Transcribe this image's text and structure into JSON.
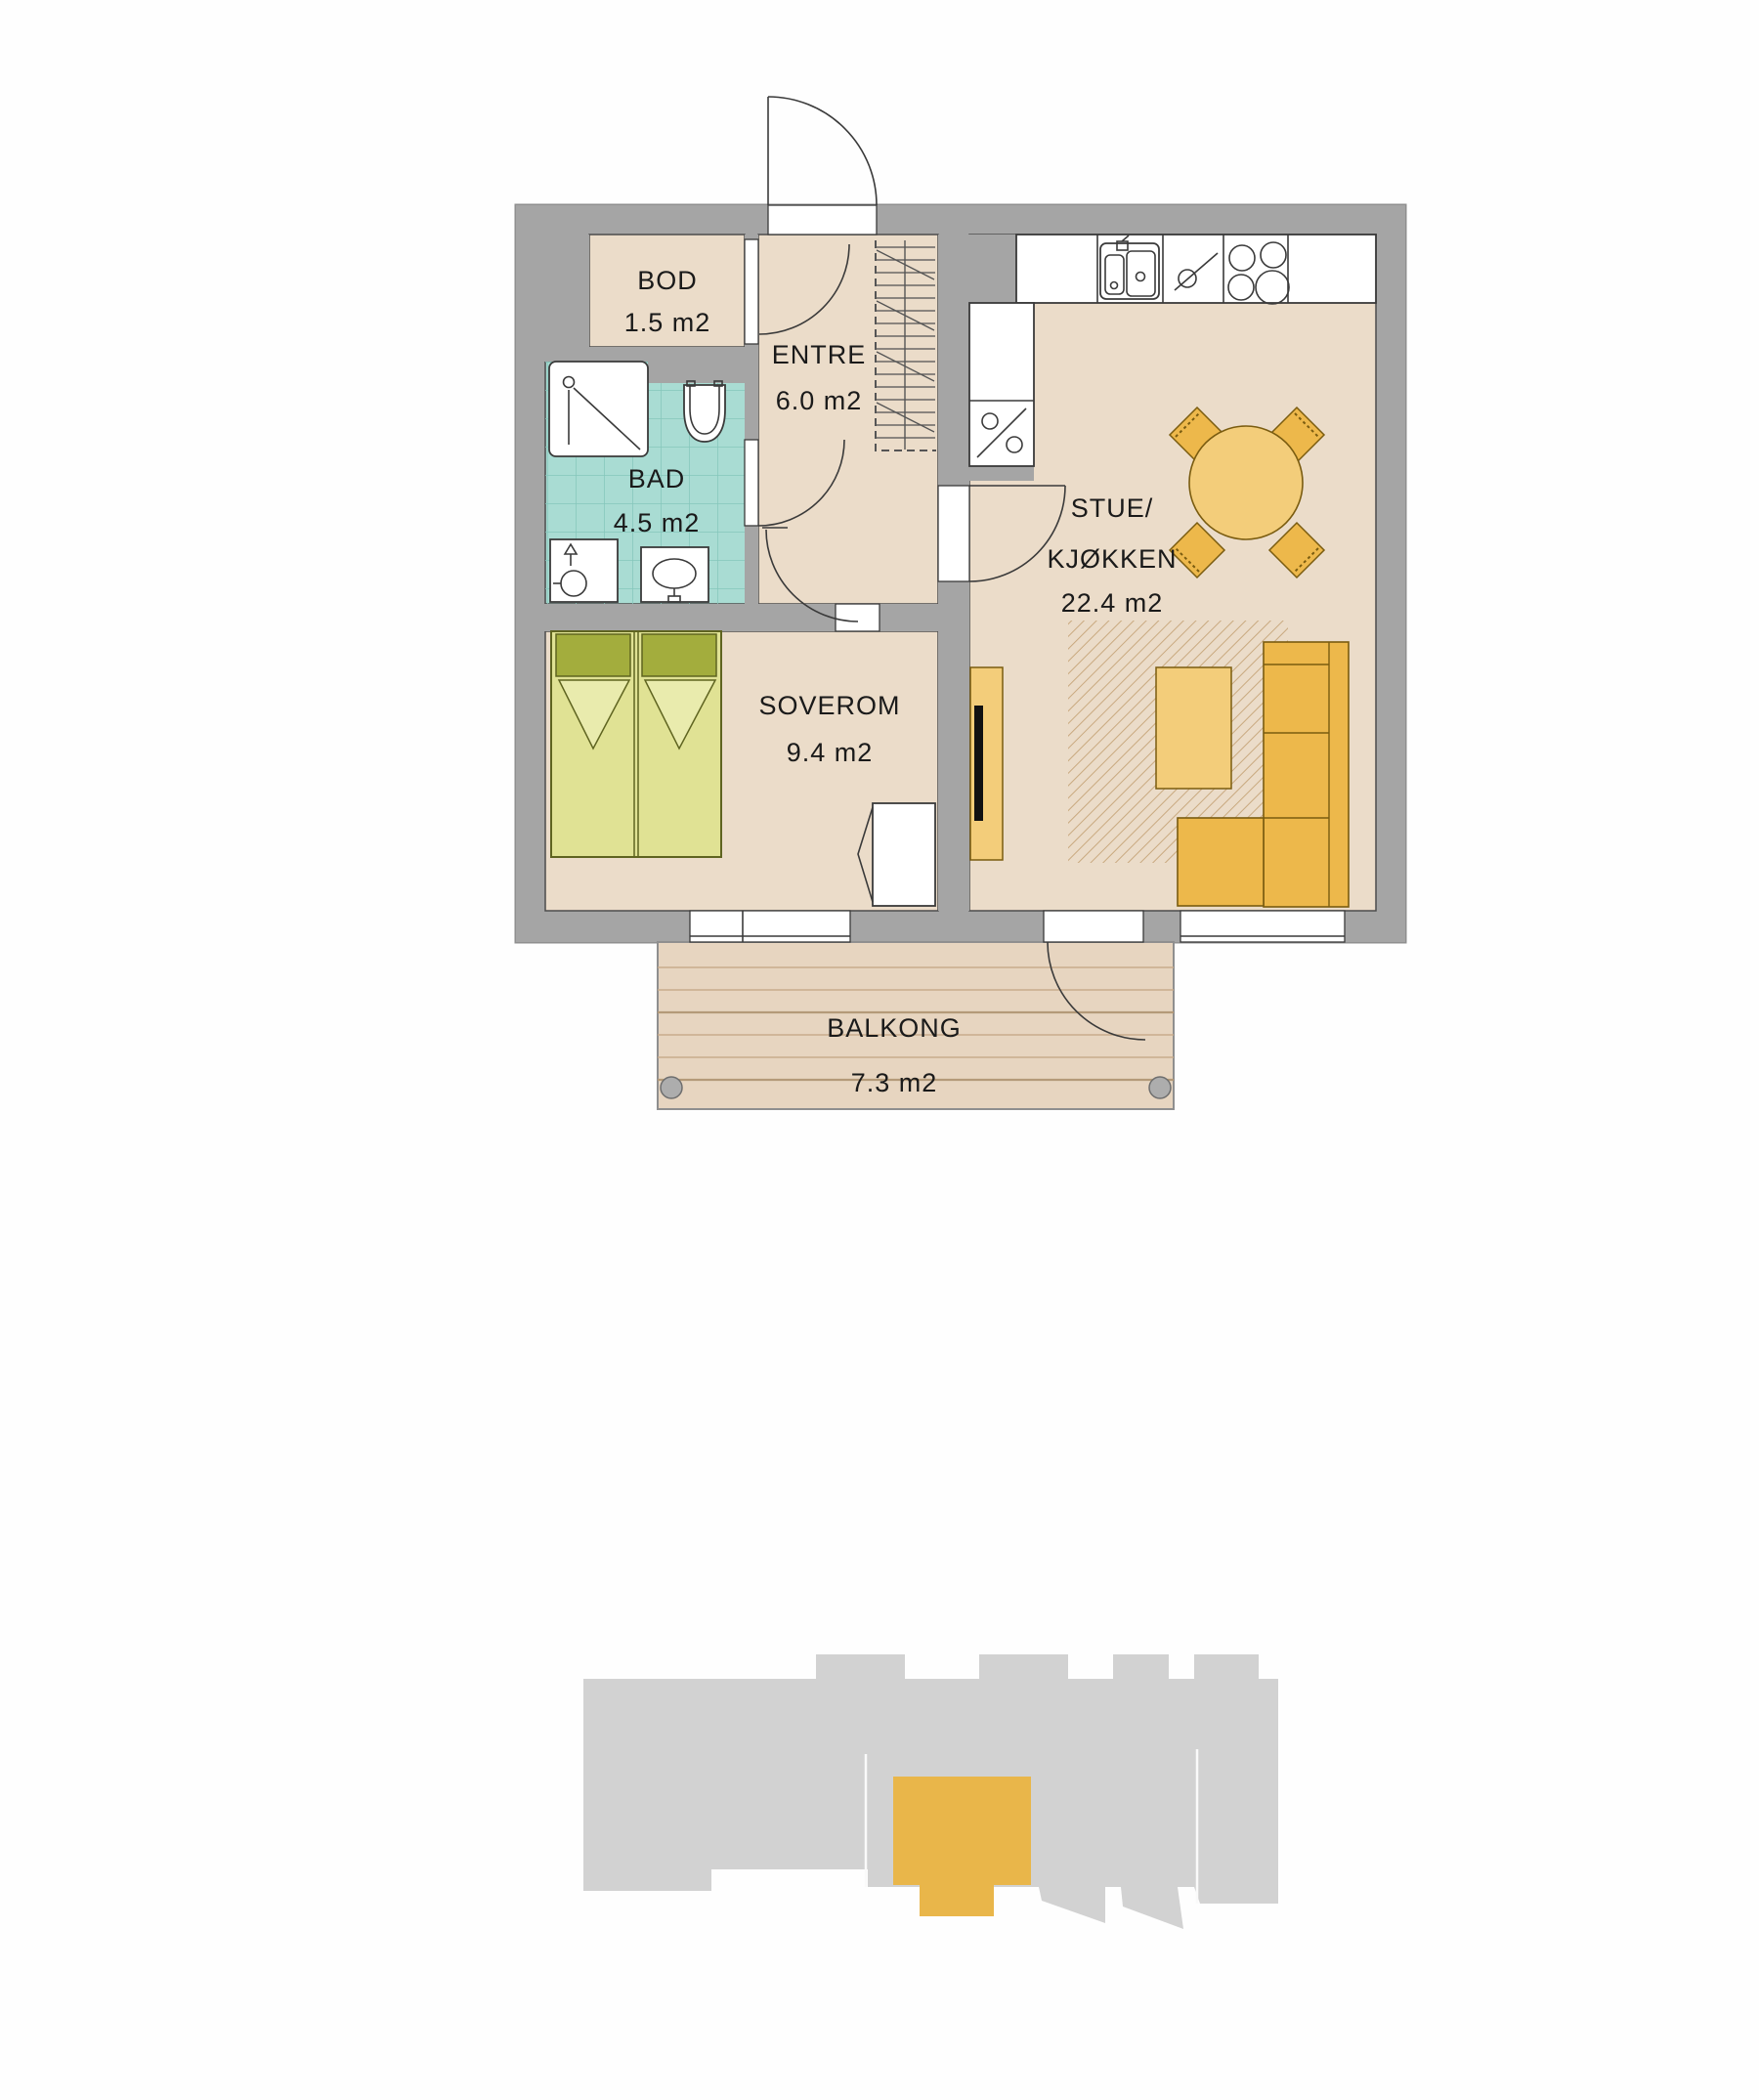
{
  "plan": {
    "rooms": {
      "bod": {
        "name": "BOD",
        "area": "1.5 m2"
      },
      "entre": {
        "name": "ENTRE",
        "area": "6.0 m2"
      },
      "bad": {
        "name": "BAD",
        "area": "4.5 m2"
      },
      "soverom": {
        "name": "SOVEROM",
        "area": "9.4 m2"
      },
      "stue": {
        "name_line1": "STUE/",
        "name_line2": "KJØKKEN",
        "area": "22.4 m2"
      },
      "balkong": {
        "name": "BALKONG",
        "area": "7.3 m2"
      }
    },
    "fixtures": {
      "kitchen": [
        "sink",
        "dishwasher",
        "cooktop",
        "refrigerator"
      ],
      "bathroom": [
        "shower",
        "toilet",
        "washing-machine",
        "washbasin"
      ],
      "entre": [
        "wardrobe"
      ],
      "furniture": [
        "double-bed",
        "bedroom-wardrobe",
        "tv-bench",
        "tv",
        "rug",
        "coffee-table",
        "corner-sofa",
        "dining-table",
        "dining-chairs"
      ]
    }
  },
  "site_map": {
    "type": "building-footprint-with-highlighted-unit"
  },
  "colors": {
    "wall": "#a5a5a5",
    "wall_edge": "#8f8f8f",
    "floor": "#ebdcc9",
    "tile": "#a9dcd3",
    "tile_grid": "#85c6bb",
    "bed": "#e0e294",
    "bed_fold": "#e9ebad",
    "pillow": "#a3ad3d",
    "bed_outline": "#5f6420",
    "orange": "#edb84b",
    "orange_light": "#f3cd7a",
    "furniture_outline": "#7a5c10",
    "rug_hatch": "#c9a97f",
    "balcony": "#e7d5c0",
    "balcony_line": "#c8ac8c",
    "site_building": "#d2d2d2",
    "site_unit": "#e9b64a",
    "white": "#ffffff"
  }
}
